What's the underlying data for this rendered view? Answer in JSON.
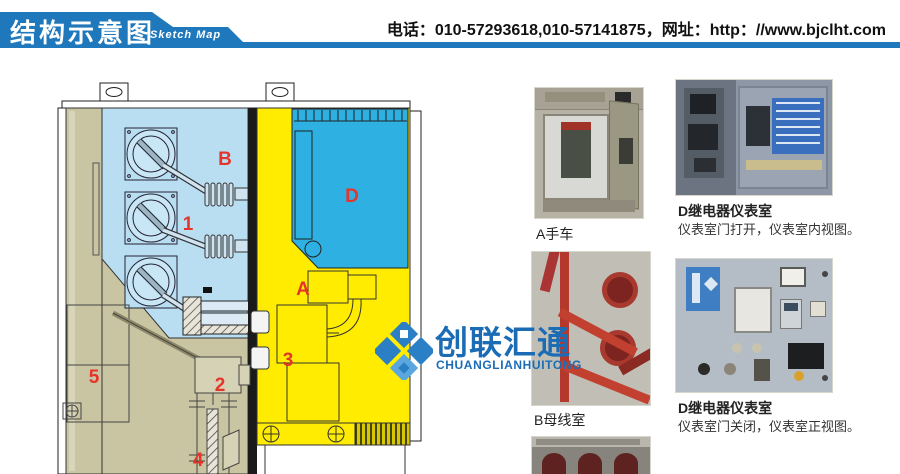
{
  "header": {
    "title_cn": "结构示意图",
    "title_en": "Sketch Map",
    "contact": "电话：010-57293618,010-57141875，网址：http：//www.bjclht.com"
  },
  "watermark": {
    "name_cn": "创联汇通",
    "name_en": "CHUANGLIANHUITONG"
  },
  "diagram": {
    "description": "switchgear-cabinet-cross-section",
    "labels": [
      {
        "text": "B"
      },
      {
        "text": "D"
      },
      {
        "text": "1"
      },
      {
        "text": "A"
      },
      {
        "text": "3"
      },
      {
        "text": "2"
      },
      {
        "text": "5"
      },
      {
        "text": "4"
      }
    ],
    "colors": {
      "busbar_room_blue": "#b9def2",
      "instrument_room_cyan": "#2fb0e2",
      "breaker_room_yellow": "#ffec00",
      "cable_room_khaki": "#c9c4a2",
      "label_red": "#e5352b",
      "banner_blue": "#1e78bb",
      "logo_blue": "#1b6cb5"
    }
  },
  "photos": {
    "a": {
      "caption": "A手车"
    },
    "b": {
      "caption": "B母线室"
    },
    "d_open": {
      "caption_title": "D继电器仪表室",
      "caption_sub": "仪表室门打开，仪表室内视图。"
    },
    "d_closed": {
      "caption_title": "D继电器仪表室",
      "caption_sub": "仪表室门关闭，仪表室正视图。"
    }
  }
}
